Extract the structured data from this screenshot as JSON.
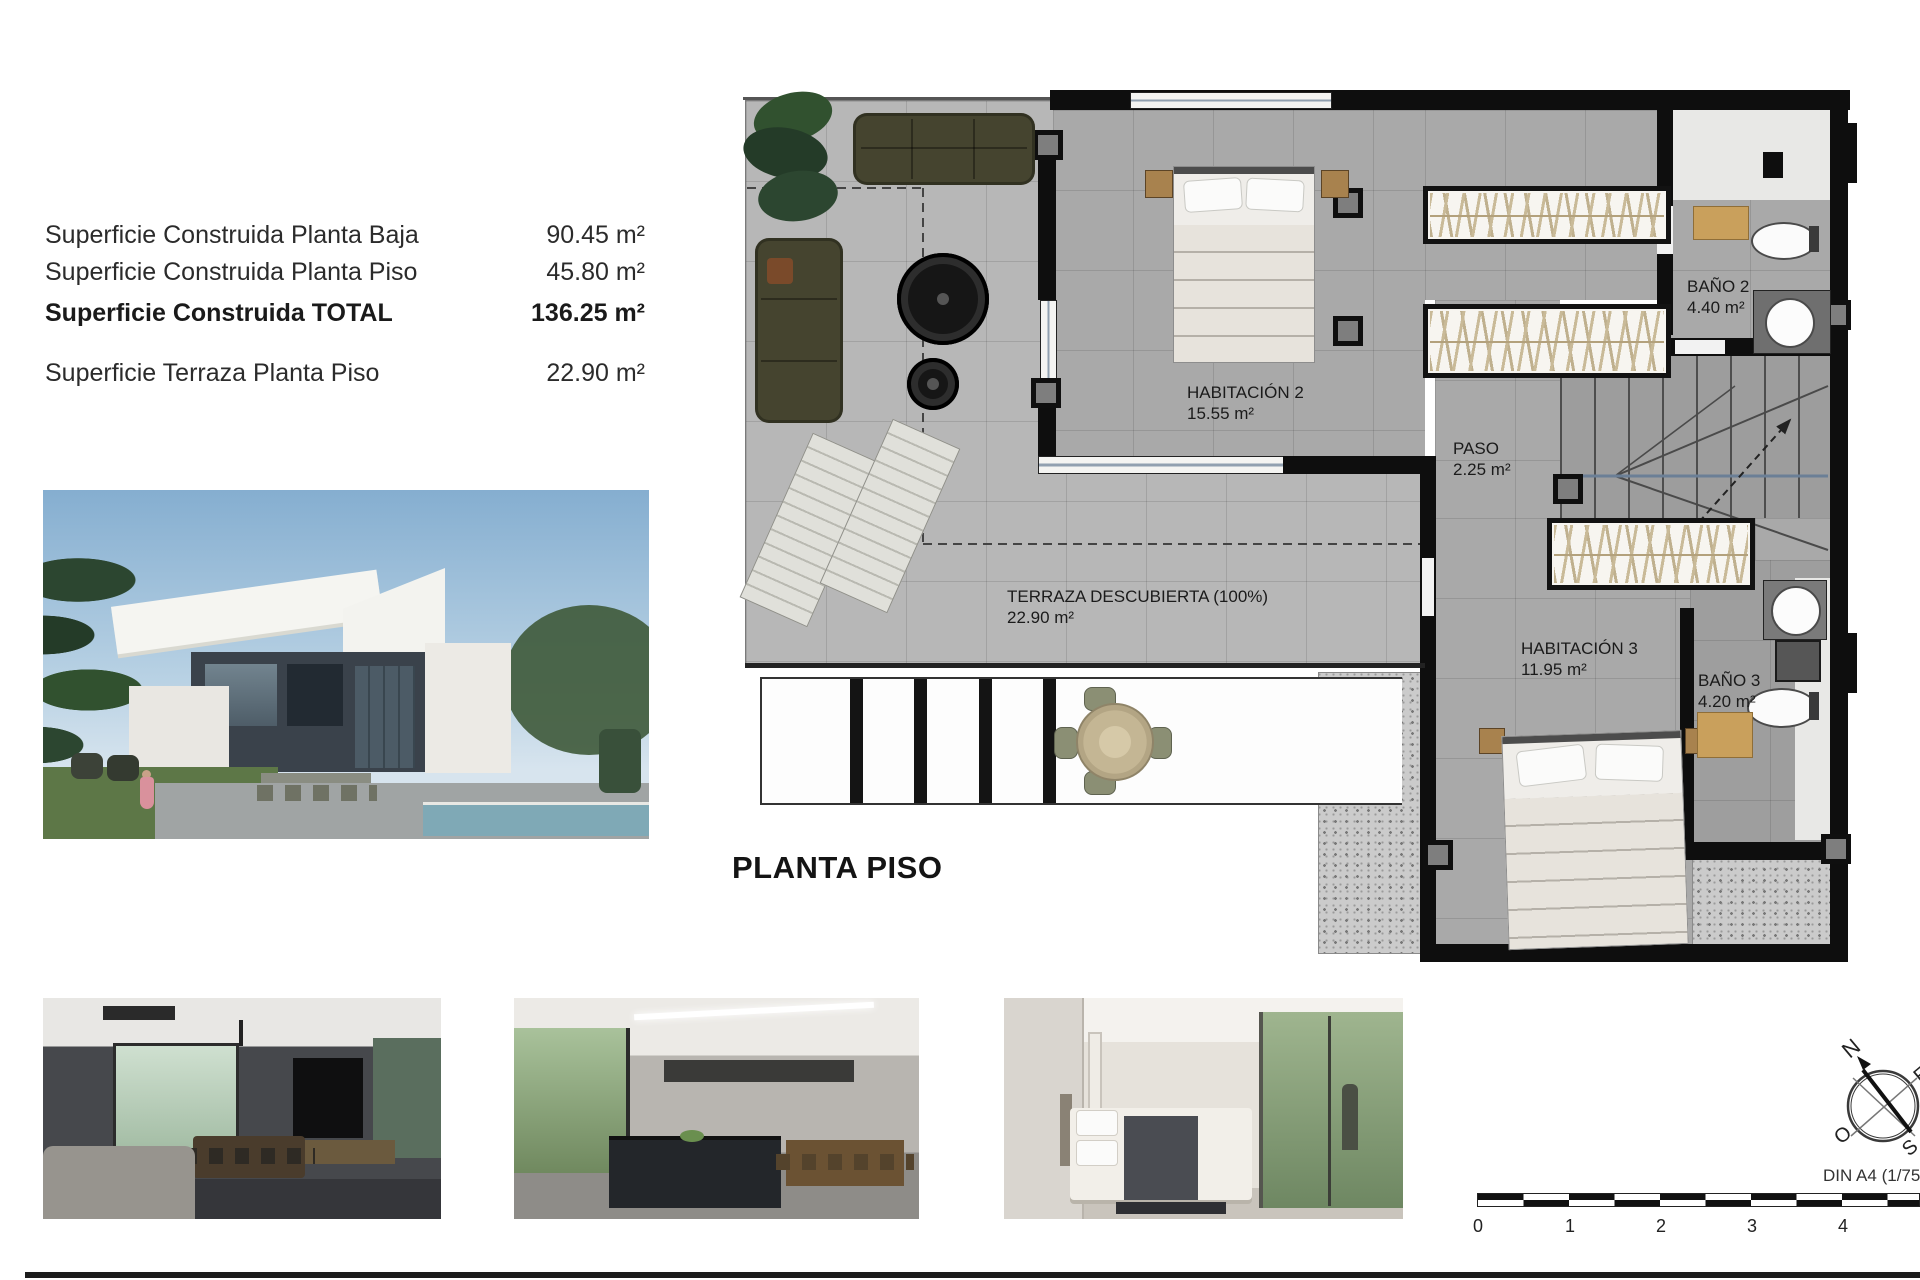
{
  "area_table": {
    "rows": [
      {
        "label": "Superficie Construida Planta Baja",
        "value": "90.45 m²"
      },
      {
        "label": "Superficie Construida Planta Piso",
        "value": "45.80 m²"
      },
      {
        "label": "Superficie Construida TOTAL",
        "value": "136.25 m²"
      },
      {
        "label": "Superficie Terraza Planta Piso",
        "value": "22.90 m²"
      }
    ]
  },
  "floor_plan": {
    "title": "PLANTA PISO",
    "rooms": [
      {
        "name": "HABITACIÓN 2",
        "area": "15.55 m²"
      },
      {
        "name": "PASO",
        "area": "2.25 m²"
      },
      {
        "name": "BAÑO 2",
        "area": "4.40 m²"
      },
      {
        "name": "HABITACIÓN 3",
        "area": "11.95 m²"
      },
      {
        "name": "BAÑO 3",
        "area": "4.20 m²"
      },
      {
        "name": "TERRAZA DESCUBIERTA (100%)",
        "area": "22.90 m²"
      }
    ]
  },
  "scale_bar": {
    "ticks": [
      "0",
      "1",
      "2",
      "3",
      "4"
    ],
    "din_label": "DIN A4 (1/75"
  },
  "compass": {
    "north": "N",
    "east": "E",
    "west": "O",
    "south": "S"
  }
}
